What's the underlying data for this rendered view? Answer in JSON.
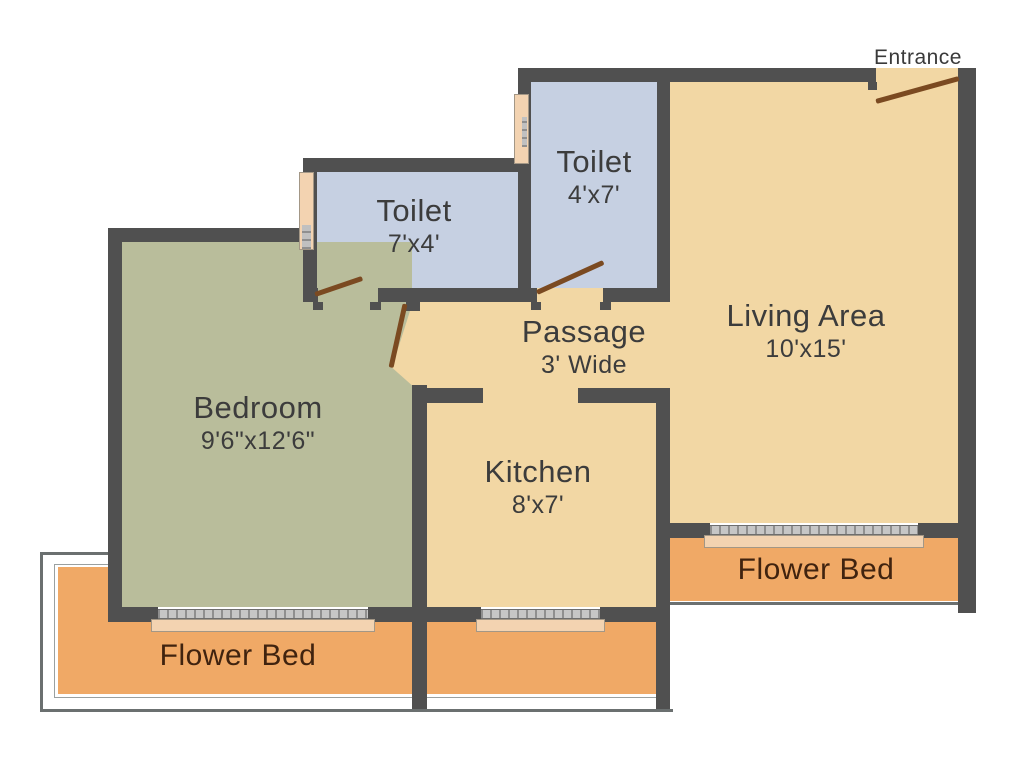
{
  "entrance": {
    "label": "Entrance"
  },
  "rooms": {
    "toilet_top": {
      "label": "Toilet",
      "dims": "4'x7'"
    },
    "toilet_left": {
      "label": "Toilet",
      "dims": "7'x4'"
    },
    "living": {
      "label": "Living Area",
      "dims": "10'x15'"
    },
    "passage": {
      "label": "Passage",
      "dims": "3' Wide"
    },
    "bedroom": {
      "label": "Bedroom",
      "dims": "9'6\"x12'6\""
    },
    "kitchen": {
      "label": "Kitchen",
      "dims": "8'x7'"
    },
    "flower_bed_left": {
      "label": "Flower Bed"
    },
    "flower_bed_right": {
      "label": "Flower Bed"
    }
  },
  "colors": {
    "wall": "#505050",
    "floor": "#f2d7a4",
    "toilet": "#c6d0e2",
    "bedroom": "#b9bd9b",
    "flower_bed": "#f0a966",
    "sill": "#f3d3b1",
    "door": "#7b4a21",
    "outline": "#6b7070",
    "text": "#3c3c3c",
    "flower_text": "#40230f"
  }
}
